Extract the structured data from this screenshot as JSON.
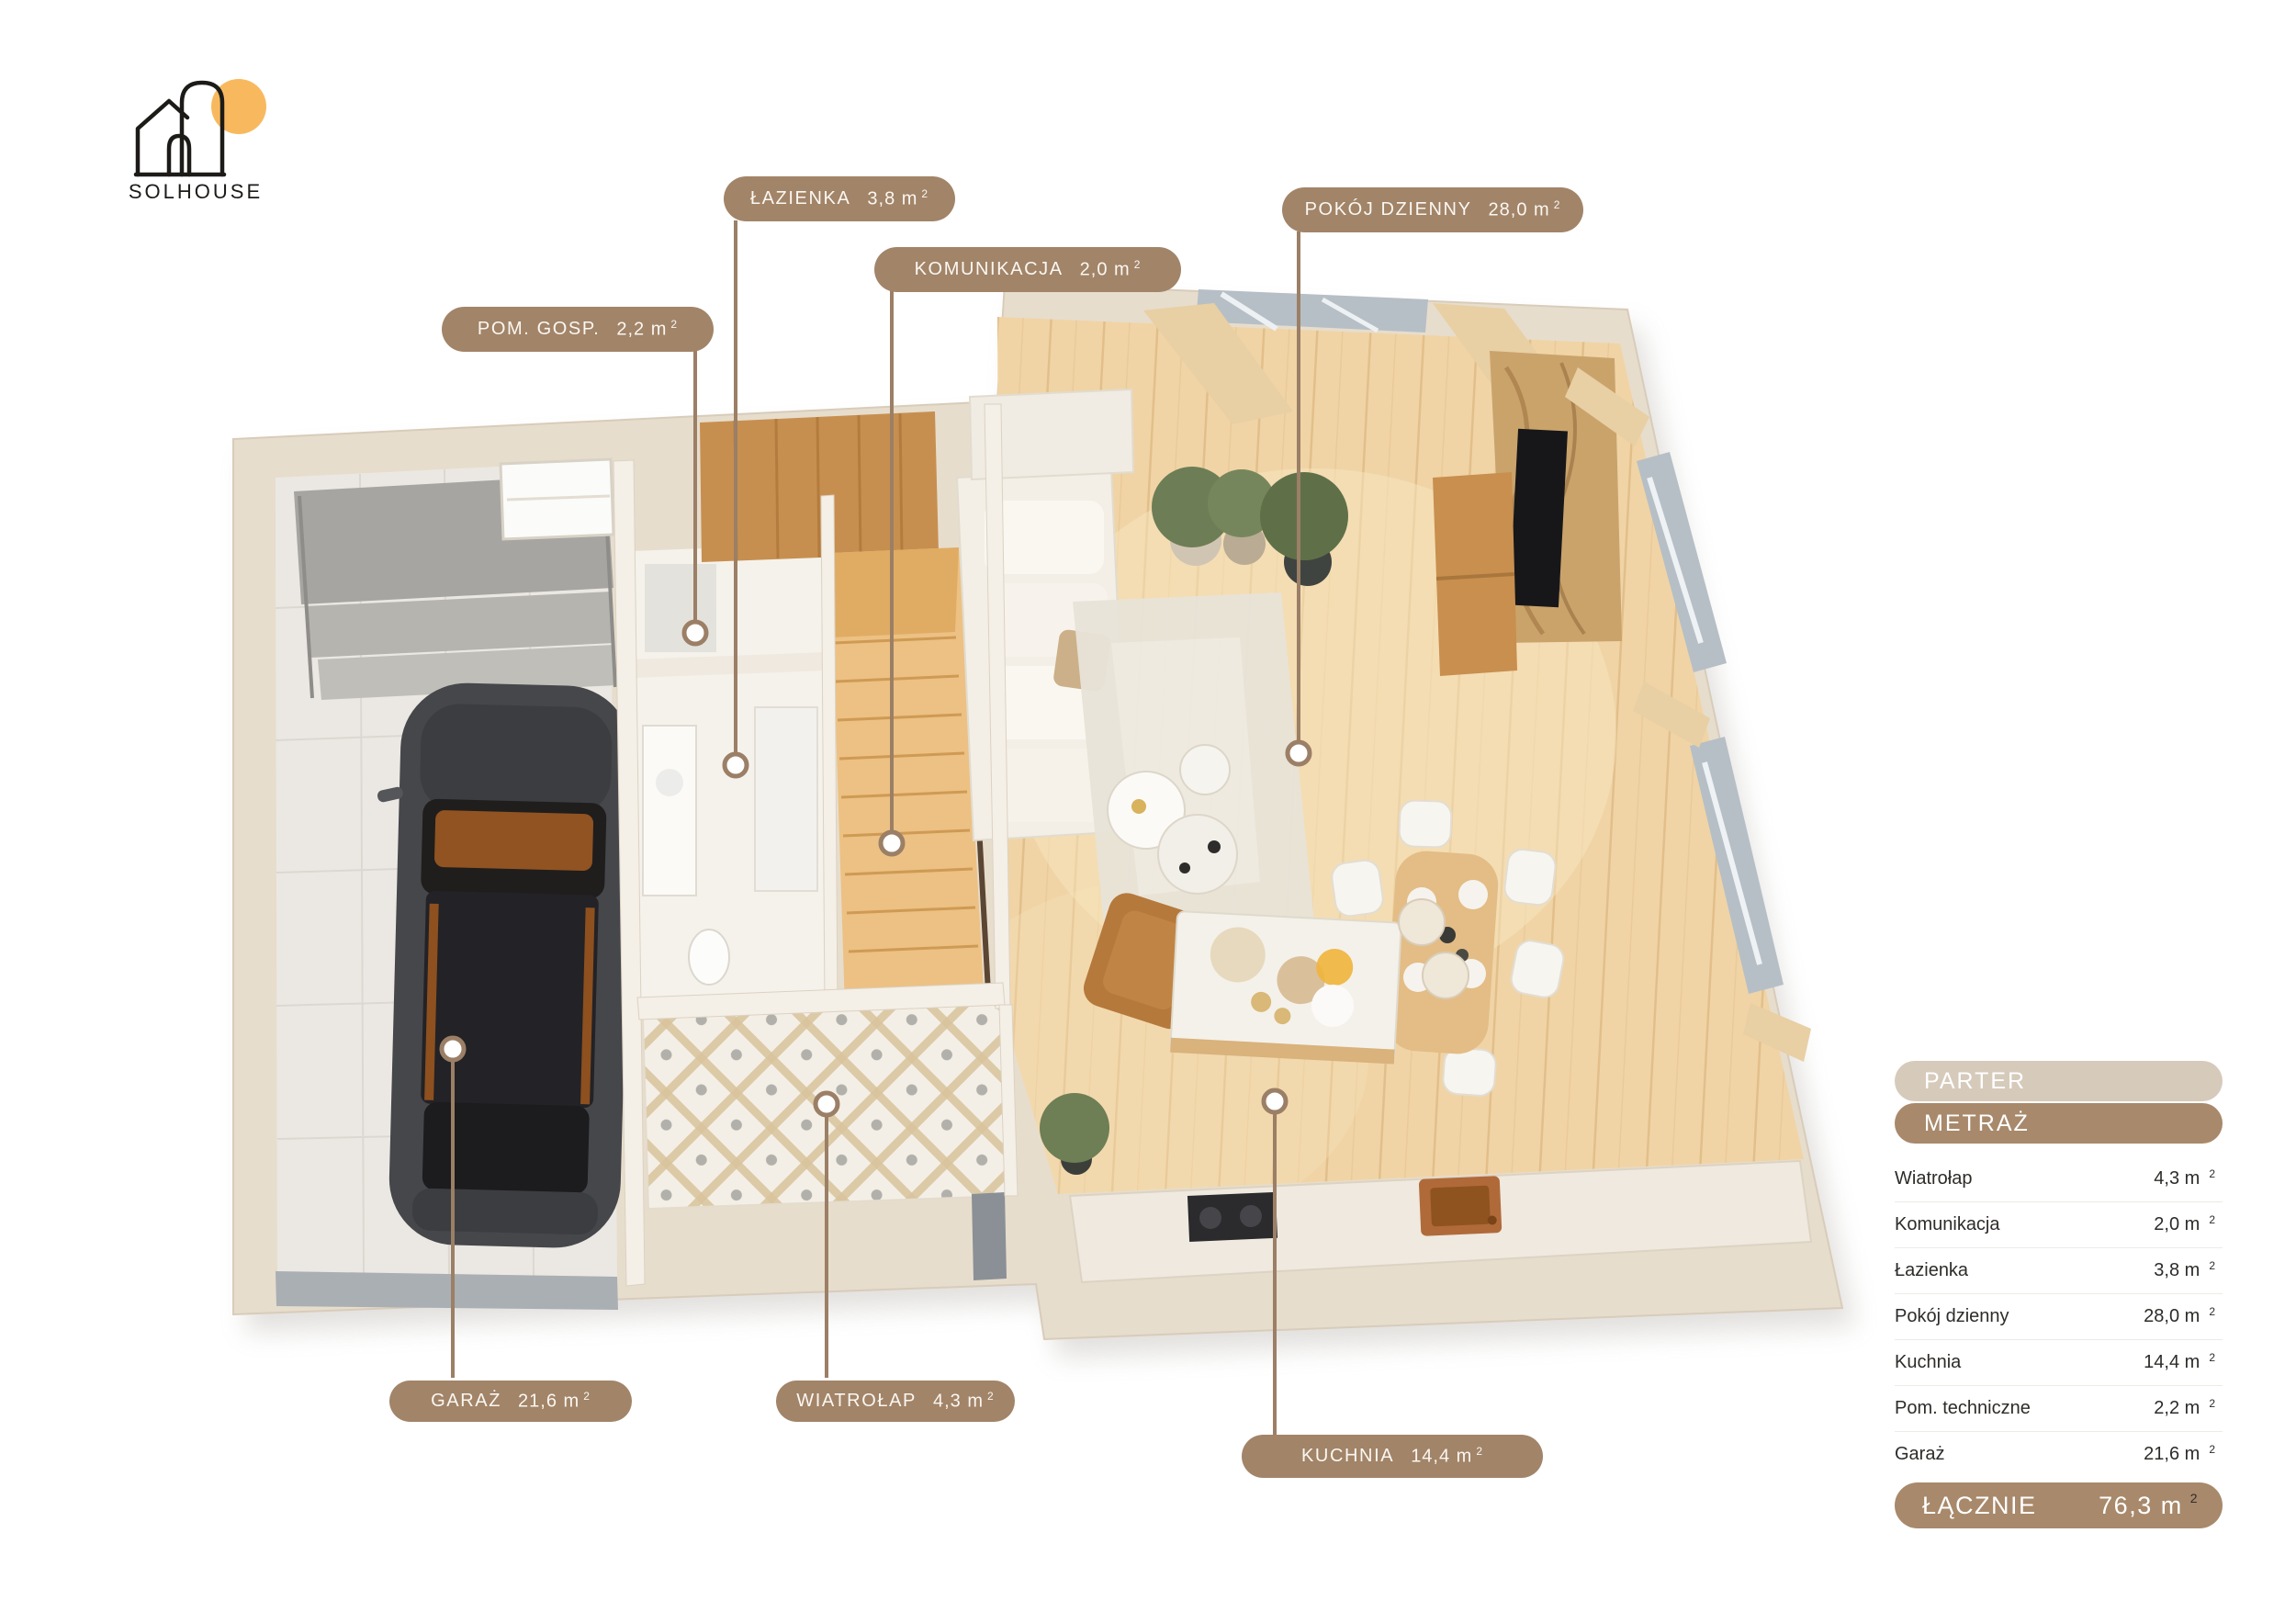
{
  "logo": {
    "brand": "SOLHOUSE",
    "icon": "house-sun-logo"
  },
  "colors": {
    "label_pill": "#a28468",
    "leader_line": "#9b7f66",
    "panel_header_light": "#d6cabb",
    "panel_header_dark": "#a8896b",
    "sun_accent": "#f8b95e"
  },
  "floor_labels": [
    {
      "id": "lazienka",
      "text": "ŁAZIENKA",
      "area": "3,8 m",
      "sup": "2"
    },
    {
      "id": "komunikacja",
      "text": "KOMUNIKACJA",
      "area": "2,0 m",
      "sup": "2"
    },
    {
      "id": "pokoj-dzienny",
      "text": "POKÓJ DZIENNY",
      "area": "28,0 m",
      "sup": "2"
    },
    {
      "id": "pom-gosp",
      "text": "POM. GOSP.",
      "area": "2,2 m",
      "sup": "2"
    },
    {
      "id": "garaz",
      "text": "GARAŻ",
      "area": "21,6 m",
      "sup": "2"
    },
    {
      "id": "wiatrolap",
      "text": "WIATROŁAP",
      "area": "4,3 m",
      "sup": "2"
    },
    {
      "id": "kuchnia",
      "text": "KUCHNIA",
      "area": "14,4 m",
      "sup": "2"
    }
  ],
  "panel": {
    "floor_header": "PARTER",
    "table_header": "METRAŻ",
    "rows": [
      {
        "label": "Wiatrołap",
        "value": "4,3 m",
        "sup": "2"
      },
      {
        "label": "Komunikacja",
        "value": "2,0 m",
        "sup": "2"
      },
      {
        "label": "Łazienka",
        "value": "3,8 m",
        "sup": "2"
      },
      {
        "label": "Pokój dzienny",
        "value": "28,0 m",
        "sup": "2"
      },
      {
        "label": "Kuchnia",
        "value": "14,4 m",
        "sup": "2"
      },
      {
        "label": "Pom. techniczne",
        "value": "2,2 m",
        "sup": "2"
      },
      {
        "label": "Garaż",
        "value": "21,6 m",
        "sup": "2"
      }
    ],
    "total": {
      "label": "ŁĄCZNIE",
      "value": "76,3 m",
      "sup": "2"
    }
  }
}
